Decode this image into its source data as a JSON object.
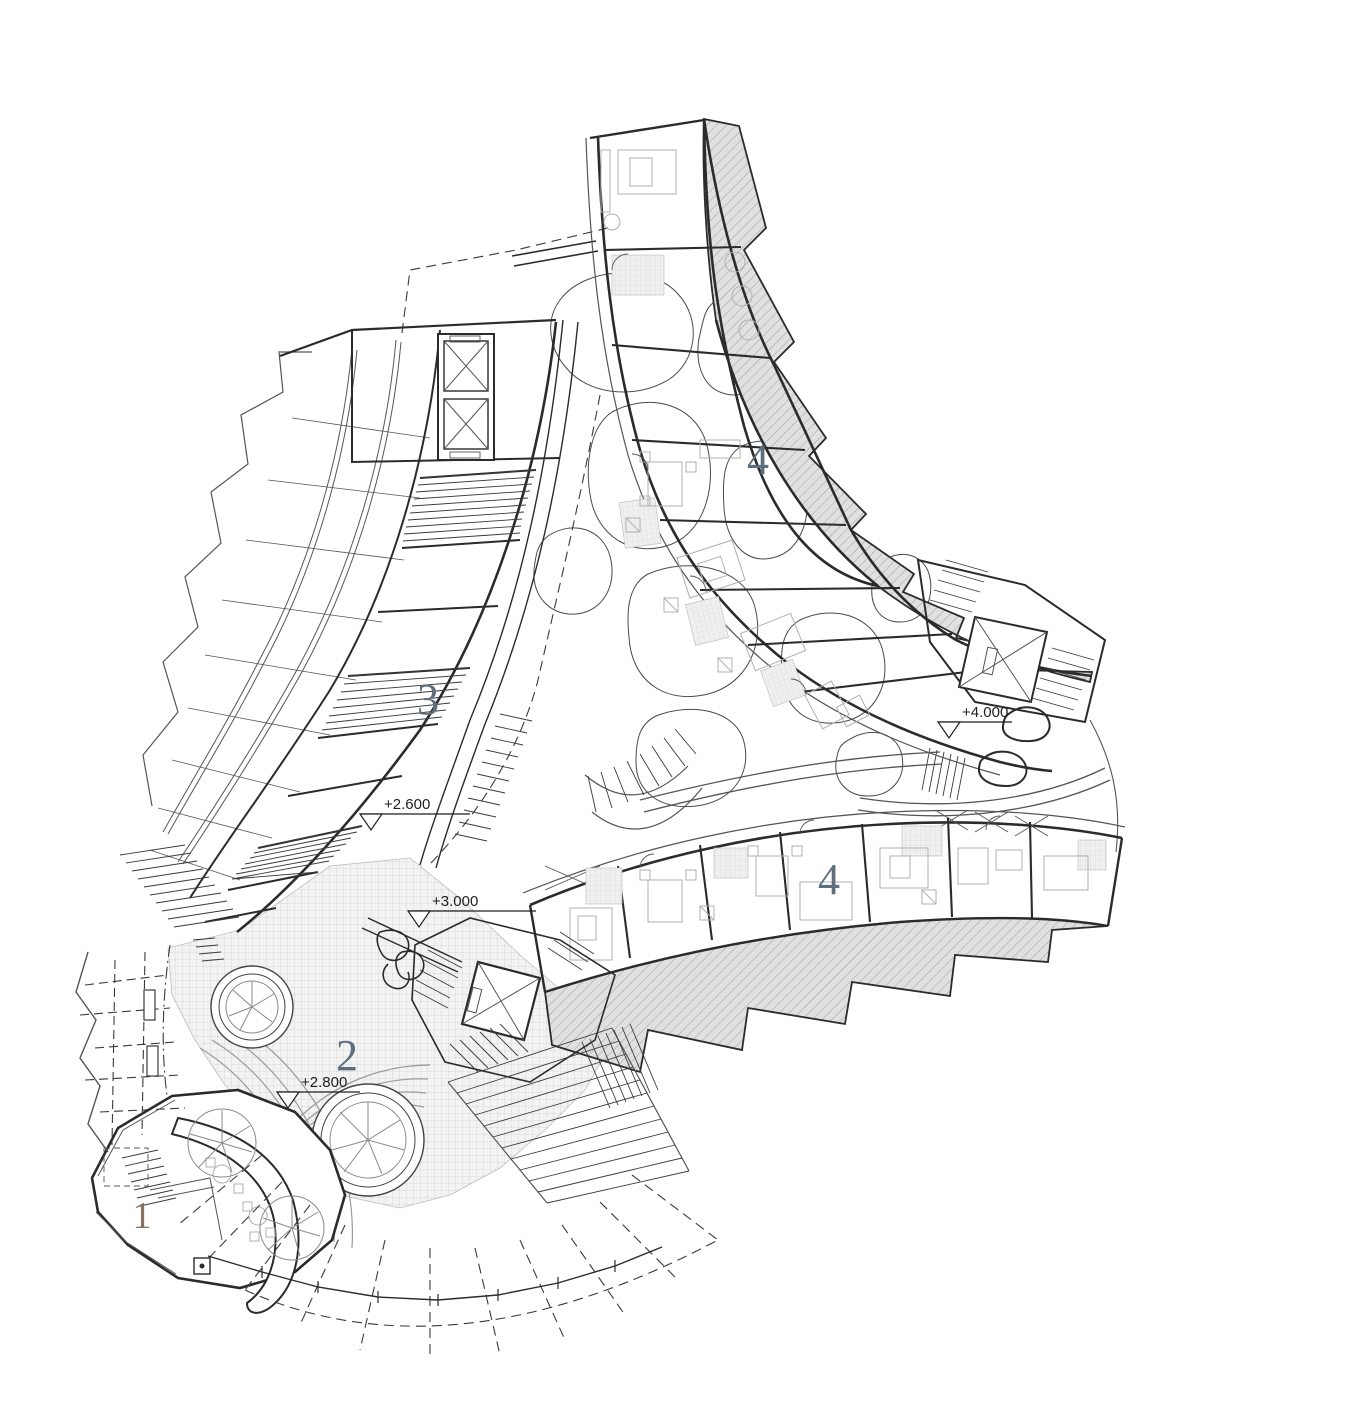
{
  "drawing": {
    "type": "architectural-floor-plan",
    "zones": [
      {
        "id": "zone-1",
        "label": "1"
      },
      {
        "id": "zone-2",
        "label": "2"
      },
      {
        "id": "zone-3",
        "label": "3"
      },
      {
        "id": "zone-4-upper",
        "label": "4"
      },
      {
        "id": "zone-4-lower",
        "label": "4"
      }
    ],
    "elevation_markers": [
      {
        "id": "marker-2600",
        "text": "+2.600"
      },
      {
        "id": "marker-3000",
        "text": "+3.000"
      },
      {
        "id": "marker-2800",
        "text": "+2.800"
      },
      {
        "id": "marker-4000",
        "text": "+4.000"
      }
    ],
    "colors": {
      "zone_label": "#5f6e7d",
      "zone_label_1": "#87705f",
      "wall": "#2b2b2b",
      "balcony_fill": "#e0e0e0",
      "balcony_hatch": "#8f8f8f",
      "plaza_fill": "#f3f3f3",
      "plaza_grid": "#cfcfcf",
      "background": "#ffffff"
    }
  }
}
